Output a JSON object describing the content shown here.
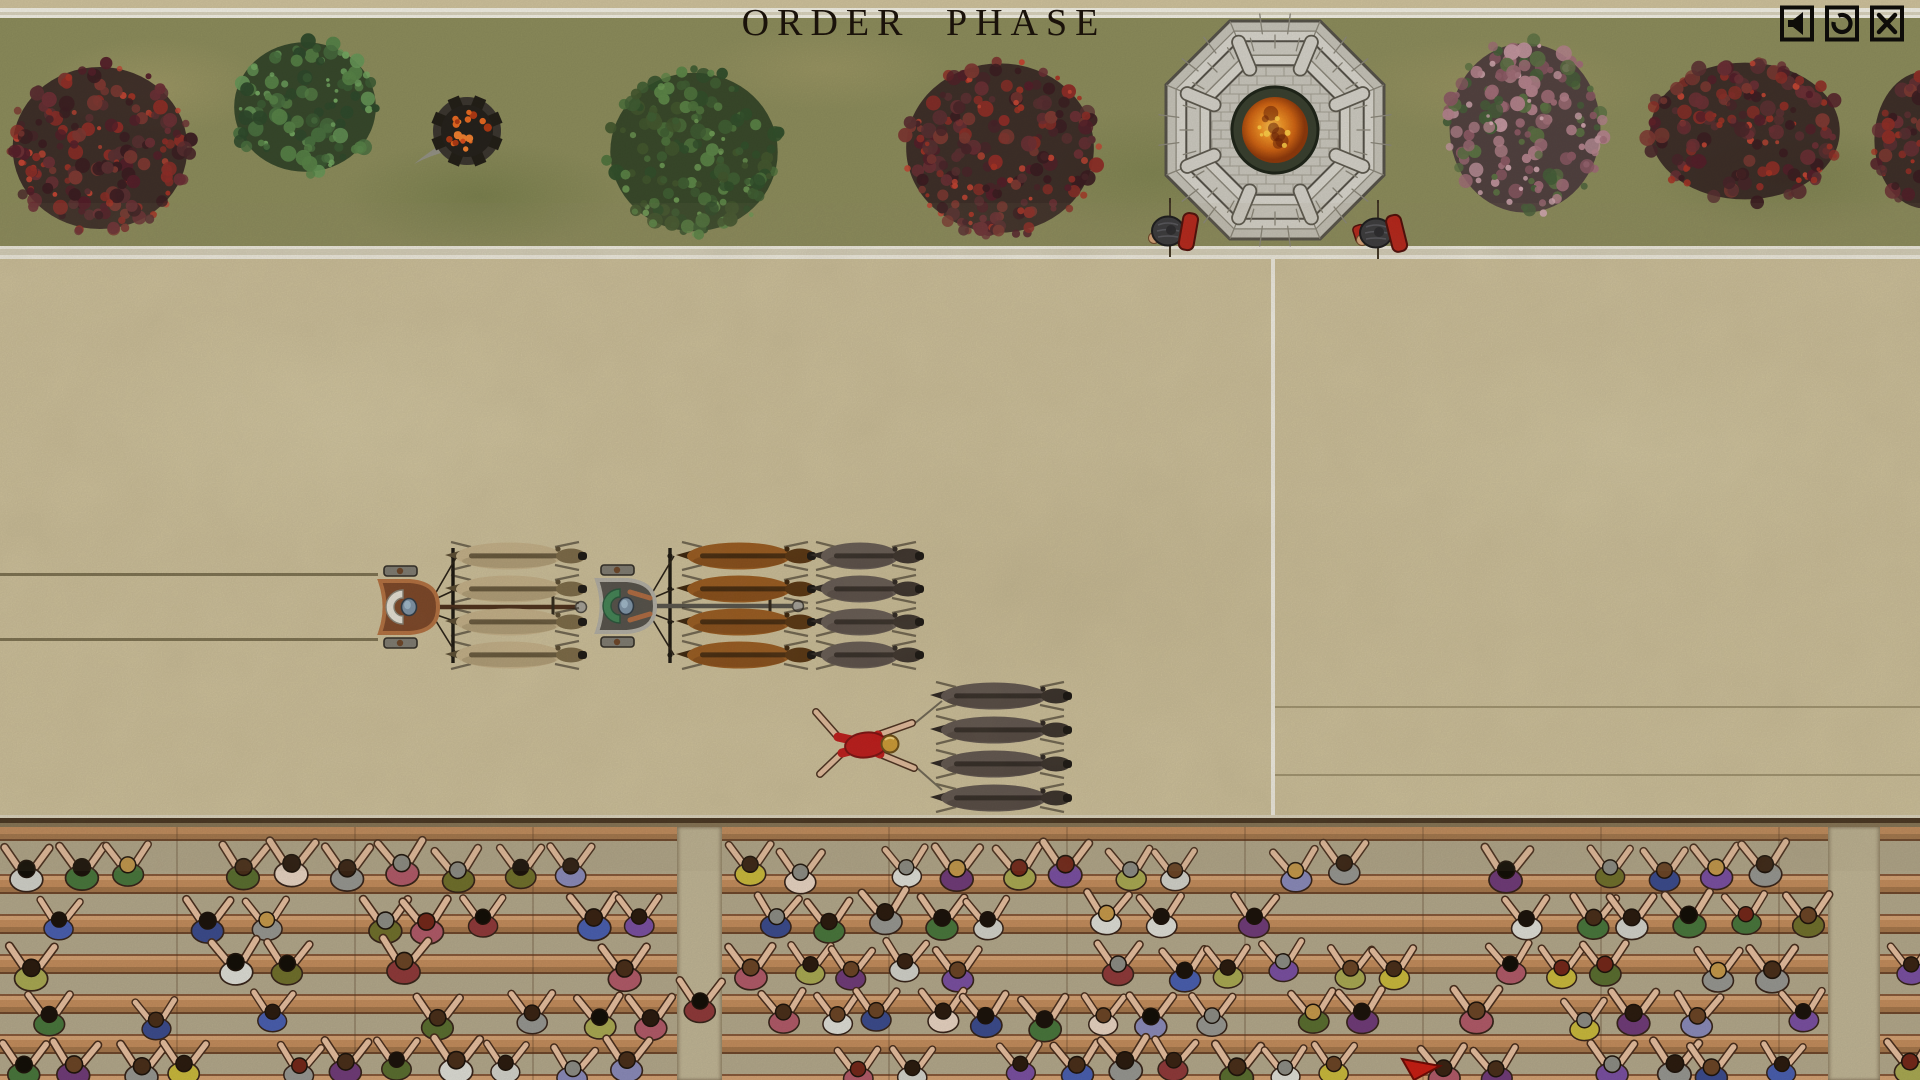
{
  "header": {
    "title": "ORDER PHASE"
  },
  "toolbar": {
    "icons": [
      {
        "id": "mute-button",
        "glyph": "speaker-icon"
      },
      {
        "id": "restart-button",
        "glyph": "restart-icon"
      },
      {
        "id": "close-button",
        "glyph": "close-icon"
      }
    ]
  },
  "palette": {
    "sand": "#cfc29c",
    "grass": "#8d8d5c",
    "white_line": "#f2efe3",
    "divider_tan": "#d9d3bd",
    "title_color": "#1a120a",
    "icon_color": "#0e0c09",
    "stands_gravel": "#b2a78a",
    "wood_light": "#d2a072",
    "wood_dark": "#6e472b",
    "skin": "#e4bd9d"
  },
  "spina": {
    "palettes": {
      "red": {
        "shadow": "#2c191d",
        "clumps": [
          "#4a262a",
          "#5c3133",
          "#6d3136",
          "#7e3a33",
          "#8f2f28",
          "#55202a",
          "#3c1e22"
        ],
        "dots": [
          "#a83426",
          "#c24634"
        ]
      },
      "green-bush": {
        "shadow": "#233820",
        "clumps": [
          "#2f4a2c",
          "#3c5c34",
          "#4a7040",
          "#588348",
          "#679758"
        ],
        "dots": [
          "#74a862"
        ]
      },
      "green": {
        "shadow": "#26391f",
        "clumps": [
          "#33502c",
          "#415f34",
          "#4f733d",
          "#5d8648",
          "#44582f"
        ],
        "dots": [
          "#6e9a55"
        ]
      },
      "pink": {
        "shadow": "#43303a",
        "clumps": [
          "#8c5a64",
          "#a06d77",
          "#b4838c",
          "#c497a0",
          "#47603a",
          "#5c7244"
        ],
        "dots": [
          "#d4aab2"
        ]
      }
    },
    "trees": [
      {
        "kind": "red",
        "cx": 100,
        "cy": 148,
        "rx": 95,
        "ry": 90
      },
      {
        "kind": "green-bush",
        "cx": 305,
        "cy": 107,
        "rx": 77,
        "ry": 72
      },
      {
        "kind": "green",
        "cx": 694,
        "cy": 152,
        "rx": 91,
        "ry": 88
      },
      {
        "kind": "red",
        "cx": 1000,
        "cy": 148,
        "rx": 102,
        "ry": 94
      },
      {
        "kind": "pink",
        "cx": 1525,
        "cy": 128,
        "rx": 82,
        "ry": 94
      },
      {
        "kind": "red",
        "cx": 1745,
        "cy": 131,
        "rx": 103,
        "ry": 76
      },
      {
        "kind": "red",
        "cx": 1925,
        "cy": 140,
        "rx": 55,
        "ry": 76
      }
    ],
    "brazier": {
      "cx": 467,
      "cy": 131,
      "r": 34
    },
    "tower": {
      "cx": 1275,
      "cy": 130,
      "r": 118,
      "stone": "#d8d5cc",
      "stone2": "#cdcac0",
      "joint": "#8c887b",
      "outline": "#57534a",
      "courtyard": "#c9c6bc",
      "pit": "#3a4130",
      "fire": [
        "#f8c050",
        "#ef9226",
        "#cf6414",
        "#8f3a0c"
      ]
    },
    "guards": [
      {
        "x": 1168,
        "y": 231,
        "armor": "#38383c",
        "shield": "#b82318"
      },
      {
        "x": 1376,
        "y": 233,
        "armor": "#38383c",
        "shield": "#b82318"
      }
    ]
  },
  "track": {
    "finish_line": {
      "x": 1271,
      "y1": 259,
      "y2": 815,
      "w": 4
    },
    "lane_lines_left": [
      {
        "y": 573,
        "x1": 0,
        "x2": 378
      },
      {
        "y": 638,
        "x1": 0,
        "x2": 378
      }
    ],
    "lane_lines_right": [
      {
        "y": 706,
        "x1": 1275,
        "x2": 1920
      },
      {
        "y": 774,
        "x1": 1275,
        "x2": 1920
      }
    ],
    "chariots": [
      {
        "id": "chariot-copper",
        "body_x": 376,
        "cy": 607,
        "rim": "#b5703f",
        "floor": "#7c4526",
        "cape": "#e9e5da",
        "cape_edge": "#8a8578",
        "head": "#7e95aa",
        "pole": "#4a2c18",
        "arms": false,
        "team": {
          "x0": 445,
          "len": 140,
          "rows": [
            556,
            589,
            622,
            655
          ],
          "body": "#c6b28a",
          "shade": "#a28f6a",
          "mane": "#57492f",
          "head": "#7b6946"
        }
      },
      {
        "id": "chariot-silver",
        "body_x": 593,
        "cy": 606,
        "rim": "#b3b0a7",
        "floor": "#53504a",
        "cape": "#3f8455",
        "cape_edge": "#26543a",
        "head": "#7e95aa",
        "pole": "#55524a",
        "arms": true,
        "team": {
          "x0": 676,
          "len": 138,
          "rows": [
            556,
            589,
            622,
            655
          ],
          "body": "#9a5a1e",
          "shade": "#7a4414",
          "mane": "#39220a",
          "head": "#57330f"
        }
      }
    ],
    "loose_teams": [
      {
        "x0": 810,
        "len": 112,
        "rows": [
          556,
          589,
          622,
          655
        ],
        "body": "#665b54",
        "shade": "#50453f",
        "mane": "#2e2722",
        "head": "#3b322c"
      },
      {
        "x0": 930,
        "len": 140,
        "rows": [
          696,
          730,
          764,
          798
        ],
        "body": "#60554f",
        "shade": "#4b403a",
        "mane": "#2b2420",
        "head": "#38302a"
      }
    ],
    "fallen_driver": {
      "cx": 866,
      "cy": 745,
      "tunic": "#c01818",
      "helmet": "#cf9c34"
    },
    "marker": {
      "points": "M1402,1059 L1440,1066 L1414,1080 Z",
      "fill": "#c71f14",
      "edge": "#6f0c06"
    }
  },
  "stands": {
    "edge_y": 815,
    "sections": [
      [
        0,
        677
      ],
      [
        722,
        1828
      ],
      [
        1880,
        1920
      ]
    ],
    "aisles": [
      [
        677,
        722
      ],
      [
        1828,
        1880
      ]
    ],
    "crowd": {
      "rows": [
        871,
        920,
        969,
        1018,
        1067
      ],
      "spacing": 54,
      "skip": 0.22,
      "seed": 11,
      "shirts": [
        "#70702c",
        "#4a5fae",
        "#969690",
        "#8f3a3a",
        "#e6d2c0",
        "#7a50a0",
        "#49763c",
        "#b05a68",
        "#d0d0c8",
        "#3c4c8c",
        "#a8a852",
        "#dcdcd4",
        "#5a6e30",
        "#8a8ab8",
        "#c8b83c",
        "#703c78"
      ],
      "hairs": [
        "#141008",
        "#2c1c10",
        "#4a2f1a",
        "#6b4526",
        "#8c8c84",
        "#c4984a",
        "#1c140c",
        "#3a2414",
        "#74281a"
      ]
    },
    "lone_spectator": {
      "x": 700,
      "y": 1004,
      "shirt": "#8f3a3a",
      "hair": "#141008"
    }
  }
}
